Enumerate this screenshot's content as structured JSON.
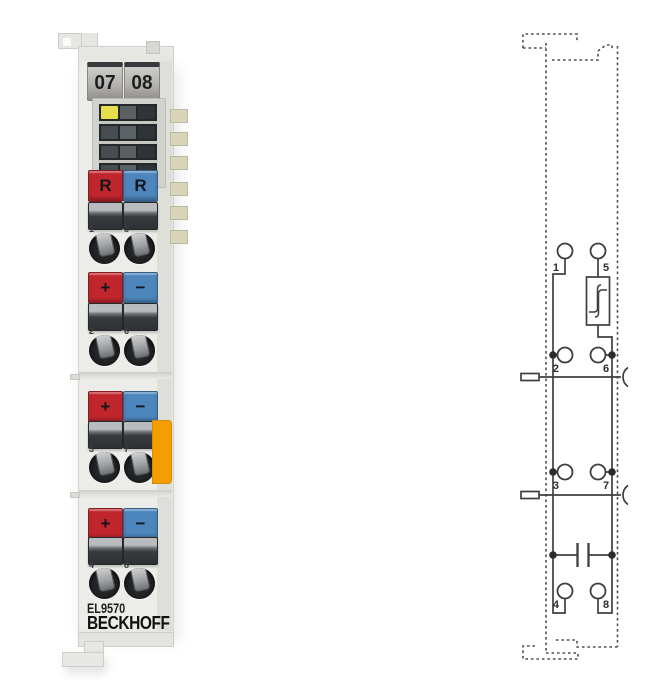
{
  "module": {
    "slot_labels": [
      "07",
      "08"
    ],
    "model": "EL9570",
    "brand": "BECKHOFF",
    "led_color": "#e6df4d",
    "button_red": "#c1262d",
    "button_blue": "#4d86bd",
    "latch_color": "#f59e00",
    "rows": [
      {
        "left_label": "R",
        "right_label": "R",
        "numbers": [
          "1",
          "5"
        ]
      },
      {
        "left_label": "+",
        "right_label": "−",
        "numbers": [
          "2",
          "6"
        ]
      },
      {
        "left_label": "+",
        "right_label": "−",
        "numbers": [
          "3",
          "7"
        ]
      },
      {
        "left_label": "+",
        "right_label": "−",
        "numbers": [
          "4",
          "8"
        ]
      }
    ]
  },
  "diagram": {
    "terminals": [
      "1",
      "5",
      "2",
      "6",
      "3",
      "7",
      "4",
      "8"
    ],
    "symbols": [
      "chopper-box",
      "capacitor",
      "power-contact-blade",
      "power-contact-socket",
      "terminal-outline"
    ]
  }
}
